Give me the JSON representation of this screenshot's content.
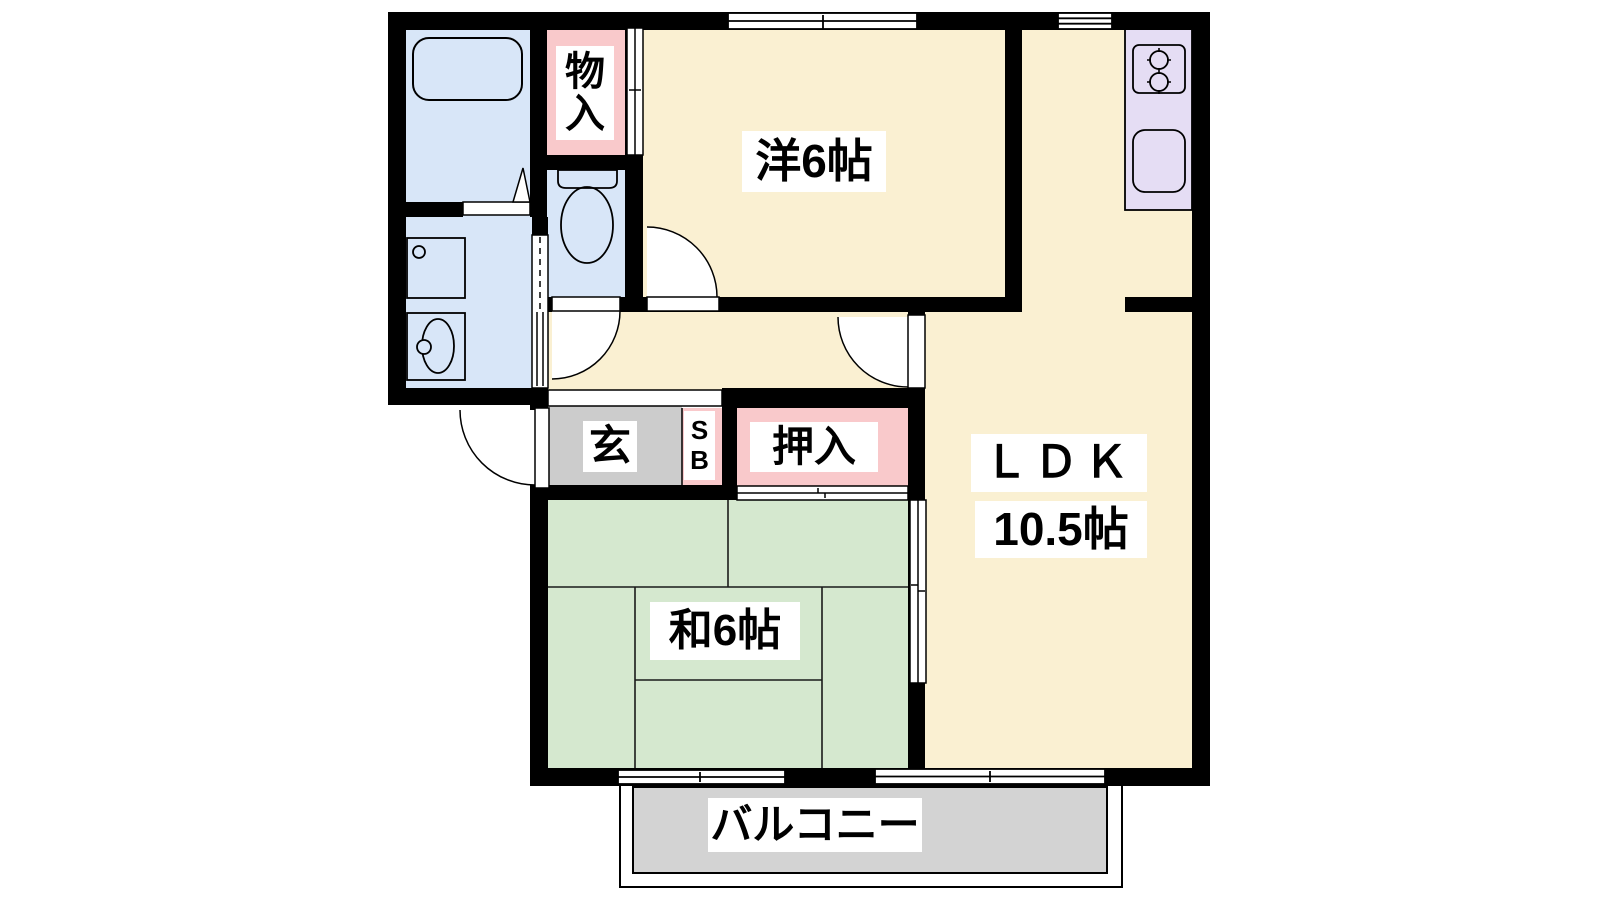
{
  "palette": {
    "wall": "#000000",
    "room_cream": "#FAF0D2",
    "tatami_green": "#D5E8CF",
    "closet_pink": "#F9C9CB",
    "water_blue": "#D8E6F8",
    "kitchen_purple": "#E5DDF4",
    "entrance_gray": "#CCCCCC",
    "balcony_gray": "#D3D3D3",
    "label_bg": "#FFFFFF"
  },
  "rooms": {
    "western_room": {
      "label": "洋6帖"
    },
    "ldk": {
      "name": "ＬＤＫ",
      "size": "10.5帖"
    },
    "japanese_room": {
      "label": "和6帖"
    },
    "storage": {
      "chars": [
        "物",
        "入"
      ]
    },
    "closet": {
      "label": "押入"
    },
    "entrance": {
      "label": "玄"
    },
    "shoe_box": {
      "chars": [
        "S",
        "B"
      ]
    },
    "balcony": {
      "label": "バルコニー"
    }
  }
}
